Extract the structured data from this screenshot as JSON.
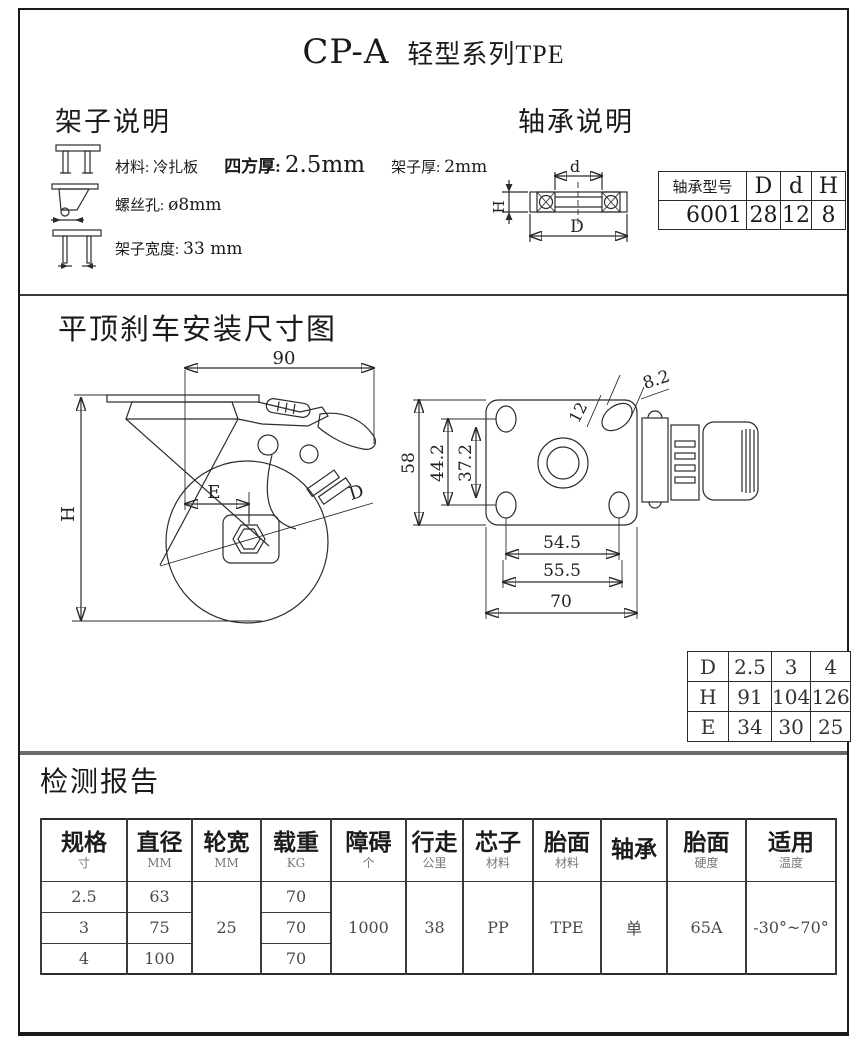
{
  "page": {
    "title_model": "CP-A",
    "title_series": "轻型系列TPE"
  },
  "frame": {
    "heading": "架子说明",
    "line1_label1": "材料:",
    "line1_value1": "冷扎板",
    "line1_label2": "四方厚:",
    "line1_value2": "2.5mm",
    "line1_label3": "架子厚:",
    "line1_value3": "2mm",
    "line2_label": "螺丝孔:",
    "line2_value": "ø8mm",
    "line3_label": "架子宽度:",
    "line3_value": "33 mm"
  },
  "bearing": {
    "heading": "轴承说明",
    "dim_d": "d",
    "dim_D": "D",
    "dim_H": "H",
    "table": {
      "col0": "轴承型号",
      "col1": "D",
      "col2": "d",
      "col3": "H",
      "model": "6001",
      "D": "28",
      "d": "12",
      "H": "8"
    }
  },
  "install": {
    "heading": "平顶刹车安装尺寸图",
    "side": {
      "width": "90",
      "height": "H",
      "offset": "E",
      "wheel": "D"
    },
    "top": {
      "h58": "58",
      "h442": "44.2",
      "h372": "37.2",
      "slot12": "12",
      "slot82": "8.2",
      "w545": "54.5",
      "w555": "55.5",
      "w70": "70"
    },
    "dhe": {
      "r0": [
        "D",
        "2.5",
        "3",
        "4"
      ],
      "r1": [
        "H",
        "91",
        "104",
        "126"
      ],
      "r2": [
        "E",
        "34",
        "30",
        "25"
      ]
    }
  },
  "report": {
    "heading": "检测报告",
    "headers": [
      {
        "main": "规格",
        "sub": "寸"
      },
      {
        "main": "直径",
        "sub": "MM"
      },
      {
        "main": "轮宽",
        "sub": "MM"
      },
      {
        "main": "载重",
        "sub": "KG"
      },
      {
        "main": "障碍",
        "sub": "个"
      },
      {
        "main": "行走",
        "sub": "公里"
      },
      {
        "main": "芯子",
        "sub": "材料"
      },
      {
        "main": "胎面",
        "sub": "材料"
      },
      {
        "main": "轴承",
        "sub": ""
      },
      {
        "main": "胎面",
        "sub": "硬度"
      },
      {
        "main": "适用",
        "sub": "温度"
      }
    ],
    "rows": [
      [
        "2.5",
        "63",
        "70"
      ],
      [
        "3",
        "75",
        "70"
      ],
      [
        "4",
        "100",
        "70"
      ]
    ],
    "merged": {
      "wheel_width": "25",
      "obstacle": "1000",
      "distance": "38",
      "core": "PP",
      "tread": "TPE",
      "bearing": "单",
      "hardness": "65A",
      "temp": "-30°~70°"
    }
  }
}
